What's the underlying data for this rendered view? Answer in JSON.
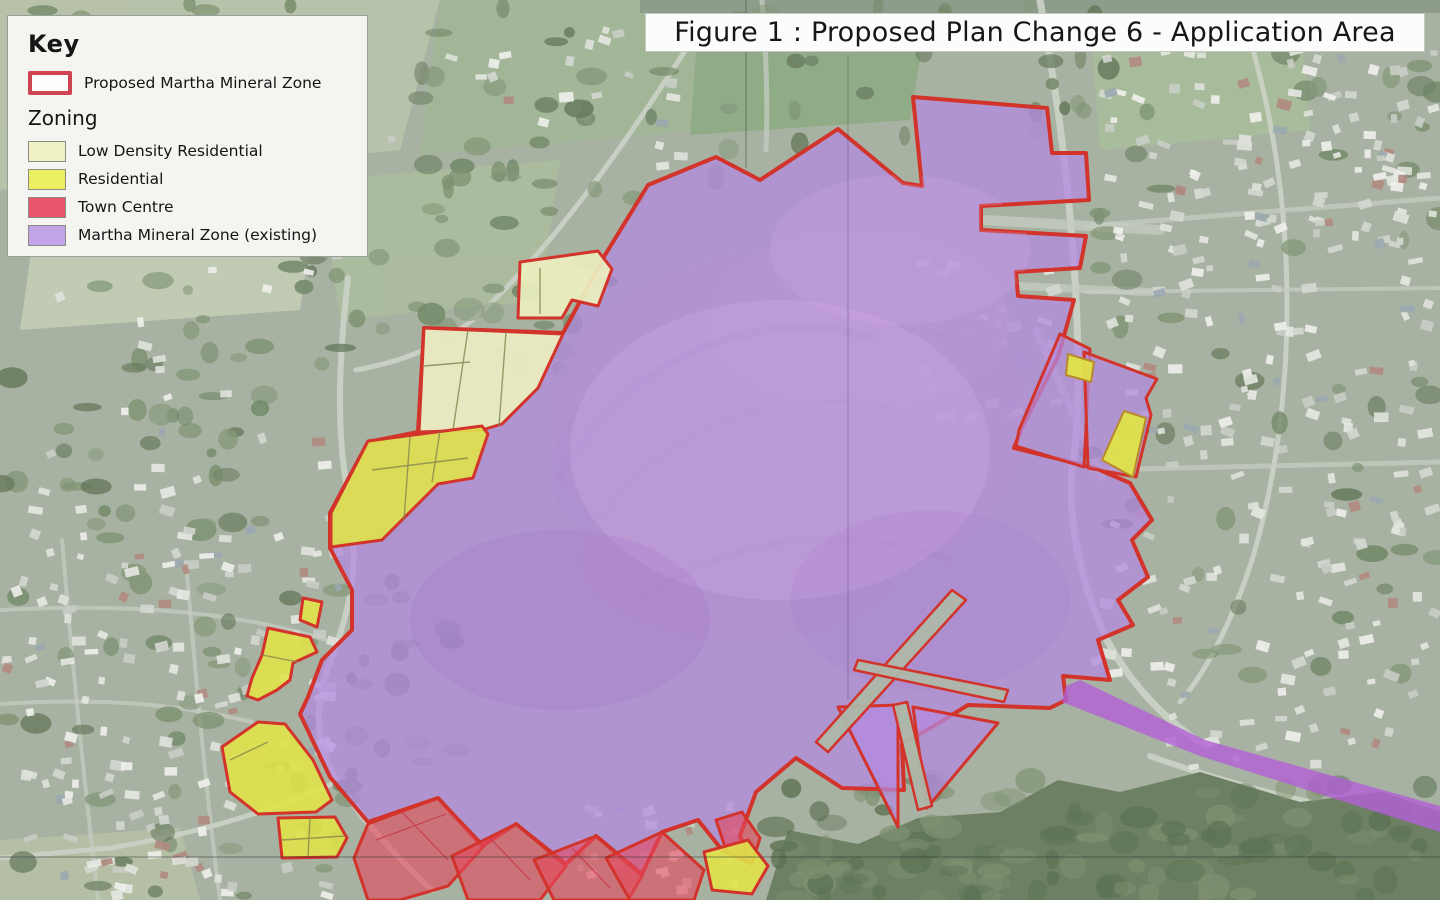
{
  "title": {
    "text": "Figure 1 : Proposed Plan Change 6 - Application Area"
  },
  "legend": {
    "heading": "Key",
    "proposed_label": "Proposed Martha Mineral Zone",
    "zoning_heading": "Zoning",
    "zoning": [
      {
        "label": "Low Density Residential",
        "color": "#f0f2c6"
      },
      {
        "label": "Residential",
        "color": "#edef63"
      },
      {
        "label": "Town Centre",
        "color": "#e8566c"
      },
      {
        "label": "Martha Mineral Zone (existing)",
        "color": "#c2a5e8"
      }
    ]
  },
  "colors": {
    "boundary": "#d2332a",
    "proposed_swatch": "#cf4353",
    "mineral": "#b48ae0",
    "mineral_strip": "#b25fd6",
    "low_density": "#ecefbe",
    "residential": "#e0e24a",
    "town_centre": "#e4485e",
    "aerial": "#a8b2a2",
    "legend_bg": "#f4f4f1",
    "title_bg": "#fcfcfa"
  }
}
